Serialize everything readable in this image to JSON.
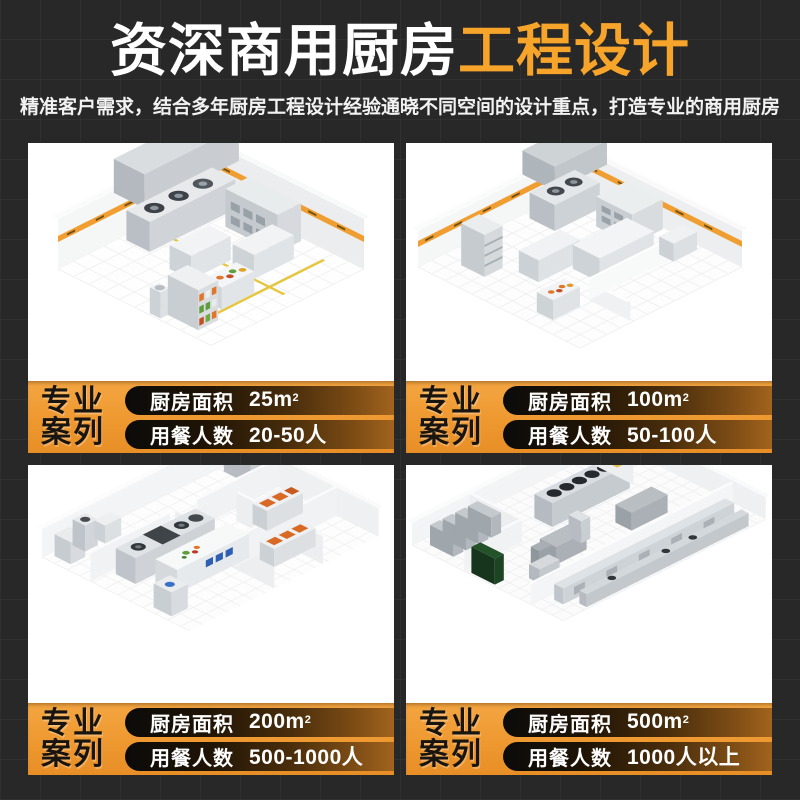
{
  "header": {
    "title_white": "资深商用厨房",
    "title_orange": "工程设计",
    "subtitle": "精准客户需求，结合多年厨房工程设计经验通晓不同空间的设计重点，打造专业的商用厨房"
  },
  "badge": {
    "line1": "专业",
    "line2": "案列"
  },
  "cards": [
    {
      "area_label": "厨房面积",
      "area_value": "25m",
      "area_sup": "2",
      "diners_label": "用餐人数",
      "diners_value": "20-50人"
    },
    {
      "area_label": "厨房面积",
      "area_value": "100m",
      "area_sup": "2",
      "diners_label": "用餐人数",
      "diners_value": "50-100人"
    },
    {
      "area_label": "厨房面积",
      "area_value": "200m",
      "area_sup": "2",
      "diners_label": "用餐人数",
      "diners_value": "500-1000人"
    },
    {
      "area_label": "厨房面积",
      "area_value": "500m",
      "area_sup": "2",
      "diners_label": "用餐人数",
      "diners_value": "1000人以上"
    }
  ],
  "colors": {
    "background": "#282828",
    "title_orange": "#F7A42A",
    "bar_orange": "#EE9830",
    "tape_orange": "#F09E31",
    "pill_dark": "#0B0B0A",
    "floor_line_yellow": "#E7C63F"
  }
}
